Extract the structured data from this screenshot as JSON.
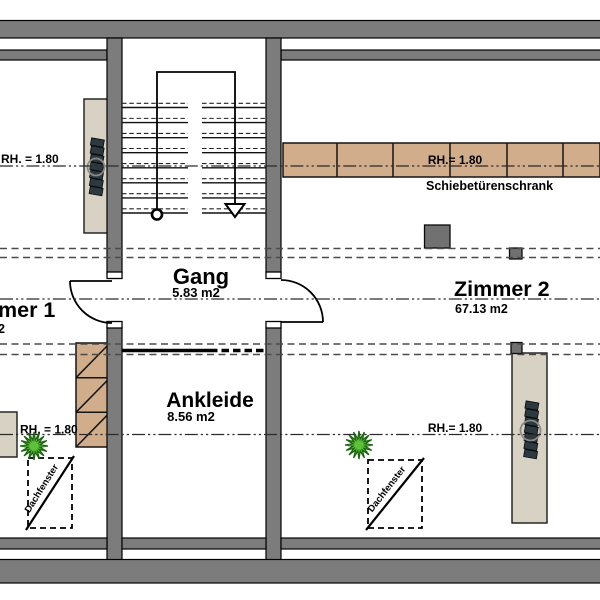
{
  "plan": {
    "rooms": {
      "gang": {
        "name": "Gang",
        "area": "5.83 m2"
      },
      "ankleide": {
        "name": "Ankleide",
        "area": "8.56 m2"
      },
      "zimmer2": {
        "name": "Zimmer 2",
        "area": "67.13 m2"
      },
      "zimmer1": {
        "name_fragment": "mer 1",
        "area_fragment": "2"
      }
    },
    "annotations": {
      "rh_top_left": "RH. = 1.80",
      "rh_top_right": "RH.= 1.80",
      "rh_bottom_left": "RH. = 1.80",
      "rh_bottom_right": "RH.= 1.80",
      "wardrobe_label": "Schiebetürenschrank",
      "roof_window_left": "Dachfenster",
      "roof_window_right": "Dachfenster"
    },
    "icons": {
      "plant": "starburst-plant",
      "stair_direction_arrow": "open-triangle-down",
      "walkline_start": "small-circle",
      "radiator": "slatted-bars-with-circle"
    },
    "colors": {
      "wall": "#7c7c7c",
      "wardrobe_tan": "#d1ad8c",
      "furniture_beige": "#d8d2c4",
      "dark_square": "#717171",
      "plant_green": "#5fc13a"
    }
  }
}
